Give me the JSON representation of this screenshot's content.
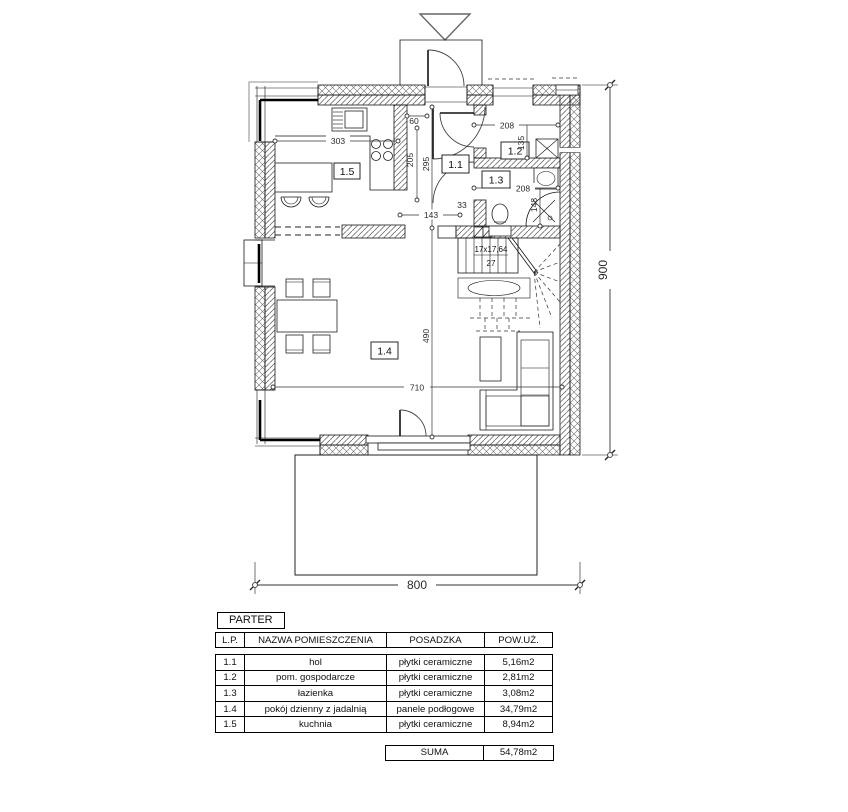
{
  "plan": {
    "rooms": {
      "r11": "1.1",
      "r12": "1.2",
      "r13": "1.3",
      "r14": "1.4",
      "r15": "1.5"
    },
    "stairs": {
      "line1": "17x17,64",
      "line2": "27"
    },
    "dims": {
      "d303": "303",
      "d60": "60",
      "d205": "205",
      "d295": "295",
      "d143": "143",
      "d33": "33",
      "d208a": "208",
      "d135": "135",
      "d208b": "208",
      "d148": "148",
      "d710": "710",
      "d490": "490",
      "d800": "800",
      "d900": "900"
    }
  },
  "table": {
    "title": "PARTER",
    "columns": {
      "lp": "L.P.",
      "name": "NAZWA POMIESZCZENIA",
      "floor": "POSADZKA",
      "area": "POW.UŻ."
    },
    "rows": [
      {
        "lp": "1.1",
        "name": "hol",
        "floor": "płytki ceramiczne",
        "area": "5,16m2"
      },
      {
        "lp": "1.2",
        "name": "pom. gospodarcze",
        "floor": "płytki ceramiczne",
        "area": "2,81m2"
      },
      {
        "lp": "1.3",
        "name": "łazienka",
        "floor": "płytki ceramiczne",
        "area": "3,08m2"
      },
      {
        "lp": "1.4",
        "name": "pokój dzienny z jadalnią",
        "floor": "panele podłogowe",
        "area": "34,79m2"
      },
      {
        "lp": "1.5",
        "name": "kuchnia",
        "floor": "płytki ceramiczne",
        "area": "8,94m2"
      }
    ],
    "summary": {
      "label": "SUMA",
      "value": "54,78m2"
    }
  }
}
